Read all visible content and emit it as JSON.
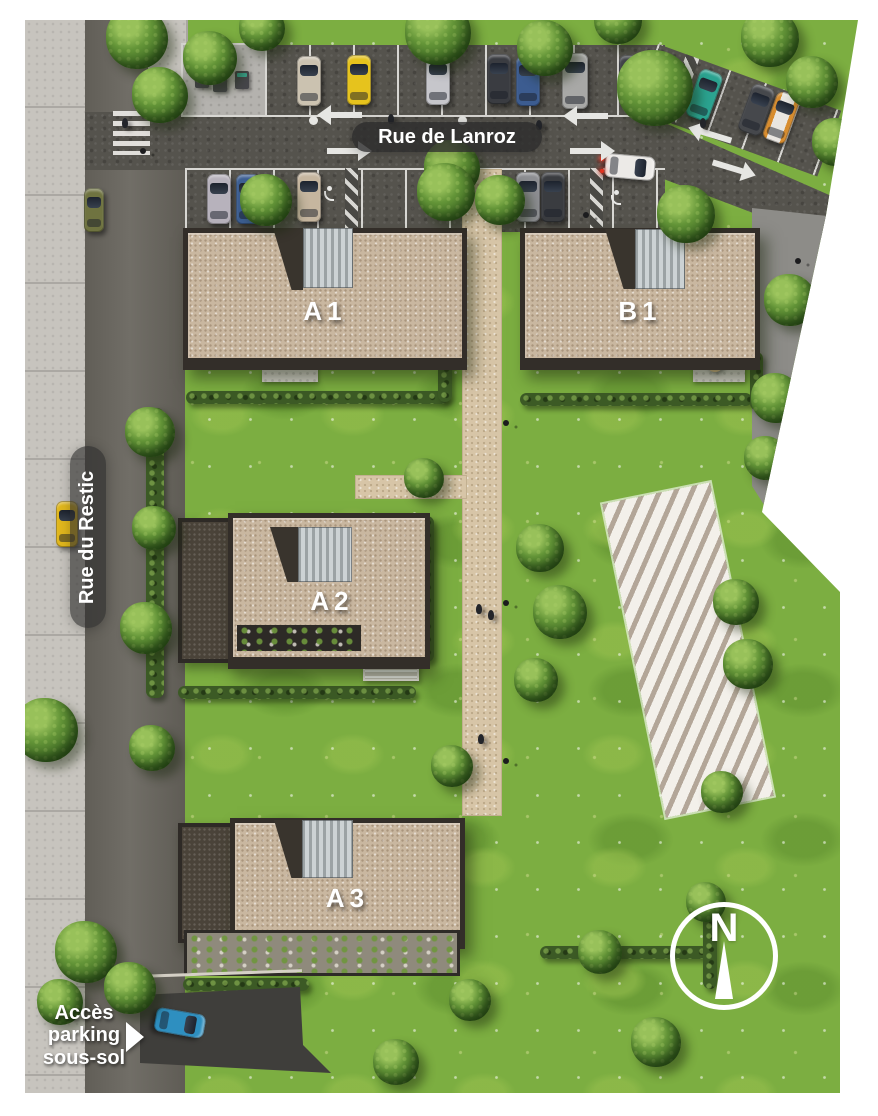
{
  "plan": {
    "streets": {
      "horizontal": "Rue de Lanroz",
      "vertical": "Rue du Restic"
    },
    "buildings": {
      "a1": "A1",
      "b1": "B1",
      "a2": "A2",
      "a3": "A3"
    },
    "parking_access_label": "Accès\nparking\nsous-sol",
    "compass_north_label": "N",
    "colors": {
      "background": "#ffffff",
      "grass": "#7cae41",
      "asphalt_main": "#55534d",
      "asphalt_side": "#6b6861",
      "sidewalk": "#c7c4be",
      "roof_gravel": "#c9b7a0",
      "roof_metal": "#c0c6c8",
      "footpath": "#d7c5a7",
      "label_pill": "#2c2c2c",
      "future_plot_stripe": "#b3a698",
      "car_yellow": "#e2b81d",
      "car_teal": "#2ba390",
      "car_blue": "#2e8fc0",
      "car_orange": "#d78c2e"
    }
  }
}
